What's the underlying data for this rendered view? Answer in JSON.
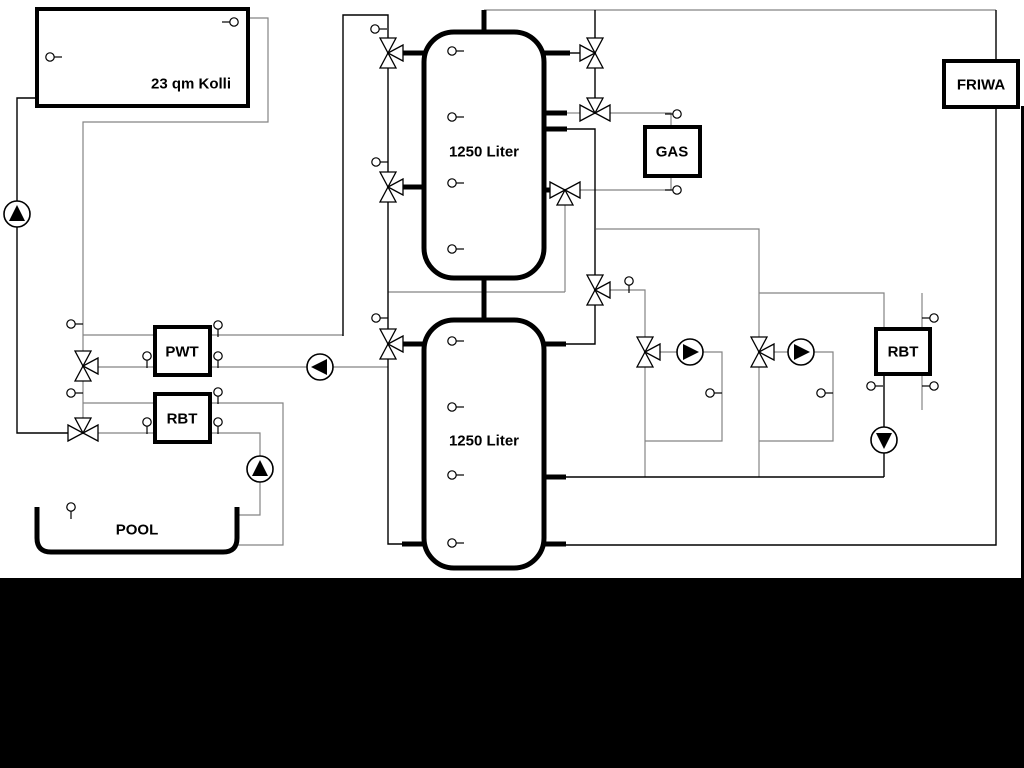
{
  "title": "Hydraulic heating schematic",
  "colors": {
    "line_black": "#000000",
    "line_gray": "#848484",
    "background": "#ffffff",
    "letterbox": "#000000"
  },
  "boxes": [
    {
      "name": "solar-collector",
      "label": "23 qm Kolli",
      "x": 37,
      "y": 9,
      "w": 211,
      "h": 97,
      "lx": 191,
      "ly": 84
    },
    {
      "name": "gas-boiler",
      "label": "GAS",
      "x": 645,
      "y": 127,
      "w": 55,
      "h": 49,
      "lx": 672,
      "ly": 152
    },
    {
      "name": "friwa-station",
      "label": "FRIWA",
      "x": 944,
      "y": 61,
      "w": 74,
      "h": 46,
      "lx": 981,
      "ly": 85
    },
    {
      "name": "pwt-heat-exchanger",
      "label": "PWT",
      "x": 155,
      "y": 327,
      "w": 55,
      "h": 48,
      "lx": 182,
      "ly": 352
    },
    {
      "name": "rbt-left",
      "label": "RBT",
      "x": 155,
      "y": 394,
      "w": 55,
      "h": 48,
      "lx": 182,
      "ly": 419
    },
    {
      "name": "rbt-right",
      "label": "RBT",
      "x": 876,
      "y": 329,
      "w": 54,
      "h": 45,
      "lx": 903,
      "ly": 352
    }
  ],
  "tanks": [
    {
      "name": "buffer-tank-1",
      "label": "1250 Liter",
      "x": 424,
      "y": 32,
      "w": 120,
      "h": 246,
      "lx": 484,
      "ly": 152
    },
    {
      "name": "buffer-tank-2",
      "label": "1250 Liter",
      "x": 424,
      "y": 320,
      "w": 120,
      "h": 248,
      "lx": 484,
      "ly": 441
    }
  ],
  "pool": {
    "name": "pool",
    "label": "POOL",
    "x1": 37,
    "x2": 237,
    "ytop": 507,
    "ybot": 552,
    "r": 14,
    "lx": 137,
    "ly": 530
  },
  "valves": [
    {
      "x": 388,
      "y": 53,
      "o": "v",
      "t": "right"
    },
    {
      "x": 388,
      "y": 187,
      "o": "v",
      "t": "right"
    },
    {
      "x": 388,
      "y": 344,
      "o": "v",
      "t": "right"
    },
    {
      "x": 595,
      "y": 53,
      "o": "v",
      "t": "left"
    },
    {
      "x": 595,
      "y": 113,
      "o": "h",
      "t": "top"
    },
    {
      "x": 565,
      "y": 190,
      "o": "h",
      "t": "bottom"
    },
    {
      "x": 595,
      "y": 290,
      "o": "v",
      "t": "right"
    },
    {
      "x": 645,
      "y": 352,
      "o": "v",
      "t": "right"
    },
    {
      "x": 759,
      "y": 352,
      "o": "v",
      "t": "right"
    },
    {
      "x": 83,
      "y": 366,
      "o": "v",
      "t": "right"
    },
    {
      "x": 83,
      "y": 433,
      "o": "h",
      "t": "top"
    }
  ],
  "pumps": [
    {
      "x": 17,
      "y": 214,
      "d": "up"
    },
    {
      "x": 320,
      "y": 367,
      "d": "left"
    },
    {
      "x": 260,
      "y": 469,
      "d": "up"
    },
    {
      "x": 690,
      "y": 352,
      "d": "right"
    },
    {
      "x": 801,
      "y": 352,
      "d": "right"
    },
    {
      "x": 884,
      "y": 440,
      "d": "down"
    }
  ],
  "sensors": [
    {
      "x": 50,
      "y": 57,
      "s": "r"
    },
    {
      "x": 234,
      "y": 22,
      "s": "l"
    },
    {
      "x": 452,
      "y": 51,
      "s": "r"
    },
    {
      "x": 452,
      "y": 117,
      "s": "r"
    },
    {
      "x": 452,
      "y": 183,
      "s": "r"
    },
    {
      "x": 452,
      "y": 249,
      "s": "r"
    },
    {
      "x": 452,
      "y": 341,
      "s": "r"
    },
    {
      "x": 452,
      "y": 407,
      "s": "r"
    },
    {
      "x": 452,
      "y": 475,
      "s": "r"
    },
    {
      "x": 452,
      "y": 543,
      "s": "r"
    },
    {
      "x": 375,
      "y": 29,
      "s": "r"
    },
    {
      "x": 376,
      "y": 162,
      "s": "r"
    },
    {
      "x": 376,
      "y": 318,
      "s": "r"
    },
    {
      "x": 71,
      "y": 324,
      "s": "r"
    },
    {
      "x": 71,
      "y": 393,
      "s": "r"
    },
    {
      "x": 218,
      "y": 325,
      "s": "d"
    },
    {
      "x": 147,
      "y": 356,
      "s": "d"
    },
    {
      "x": 218,
      "y": 356,
      "s": "d"
    },
    {
      "x": 218,
      "y": 392,
      "s": "d"
    },
    {
      "x": 147,
      "y": 422,
      "s": "d"
    },
    {
      "x": 218,
      "y": 422,
      "s": "d"
    },
    {
      "x": 71,
      "y": 507,
      "s": "d"
    },
    {
      "x": 677,
      "y": 114,
      "s": "l"
    },
    {
      "x": 677,
      "y": 190,
      "s": "l"
    },
    {
      "x": 629,
      "y": 281,
      "s": "d"
    },
    {
      "x": 710,
      "y": 393,
      "s": "r"
    },
    {
      "x": 821,
      "y": 393,
      "s": "r"
    },
    {
      "x": 871,
      "y": 386,
      "s": "r"
    },
    {
      "x": 934,
      "y": 318,
      "s": "l"
    },
    {
      "x": 934,
      "y": 386,
      "s": "l"
    }
  ],
  "lines_black": [
    [
      [
        37,
        98
      ],
      [
        17,
        98
      ],
      [
        17,
        433
      ],
      [
        68,
        433
      ]
    ],
    [
      [
        343,
        336
      ],
      [
        343,
        15
      ],
      [
        388,
        15
      ],
      [
        388,
        38
      ]
    ],
    [
      [
        388,
        68
      ],
      [
        388,
        172
      ]
    ],
    [
      [
        388,
        202
      ],
      [
        388,
        329
      ]
    ],
    [
      [
        388,
        359
      ],
      [
        388,
        544
      ],
      [
        402,
        544
      ]
    ],
    [
      [
        595,
        10
      ],
      [
        595,
        38
      ]
    ],
    [
      [
        595,
        68
      ],
      [
        595,
        98
      ]
    ],
    [
      [
        567,
        129
      ],
      [
        595,
        129
      ],
      [
        595,
        275
      ]
    ],
    [
      [
        595,
        305
      ],
      [
        595,
        344
      ],
      [
        566,
        344
      ]
    ],
    [
      [
        884,
        374
      ],
      [
        884,
        477
      ]
    ],
    [
      [
        565,
        477
      ],
      [
        884,
        477
      ]
    ],
    [
      [
        996,
        10
      ],
      [
        996,
        61
      ]
    ],
    [
      [
        996,
        107
      ],
      [
        996,
        545
      ],
      [
        565,
        545
      ]
    ],
    [
      [
        570,
        53
      ],
      [
        580,
        53
      ]
    ]
  ],
  "lines_gray": [
    [
      [
        248,
        18
      ],
      [
        268,
        18
      ],
      [
        268,
        122
      ],
      [
        83,
        122
      ],
      [
        83,
        351
      ]
    ],
    [
      [
        83,
        335
      ],
      [
        155,
        335
      ]
    ],
    [
      [
        210,
        335
      ],
      [
        343,
        335
      ]
    ],
    [
      [
        98,
        367
      ],
      [
        155,
        367
      ]
    ],
    [
      [
        210,
        367
      ],
      [
        388,
        367
      ]
    ],
    [
      [
        388,
        292
      ],
      [
        565,
        292
      ]
    ],
    [
      [
        565,
        292
      ],
      [
        565,
        205
      ]
    ],
    [
      [
        484,
        10
      ],
      [
        996,
        10
      ]
    ],
    [
      [
        610,
        290
      ],
      [
        645,
        290
      ],
      [
        645,
        337
      ]
    ],
    [
      [
        660,
        352
      ],
      [
        678,
        352
      ]
    ],
    [
      [
        702,
        352
      ],
      [
        722,
        352
      ],
      [
        722,
        441
      ],
      [
        645,
        441
      ]
    ],
    [
      [
        645,
        367
      ],
      [
        645,
        477
      ]
    ],
    [
      [
        596,
        229
      ],
      [
        759,
        229
      ],
      [
        759,
        337
      ]
    ],
    [
      [
        759,
        293
      ],
      [
        884,
        293
      ],
      [
        884,
        329
      ]
    ],
    [
      [
        774,
        352
      ],
      [
        789,
        352
      ]
    ],
    [
      [
        813,
        352
      ],
      [
        833,
        352
      ],
      [
        833,
        441
      ],
      [
        759,
        441
      ]
    ],
    [
      [
        759,
        367
      ],
      [
        759,
        477
      ]
    ],
    [
      [
        922,
        293
      ],
      [
        922,
        410
      ]
    ],
    [
      [
        610,
        113
      ],
      [
        671,
        113
      ],
      [
        671,
        127
      ]
    ],
    [
      [
        580,
        190
      ],
      [
        671,
        190
      ],
      [
        671,
        176
      ]
    ],
    [
      [
        83,
        381
      ],
      [
        83,
        418
      ]
    ],
    [
      [
        83,
        403
      ],
      [
        155,
        403
      ]
    ],
    [
      [
        210,
        403
      ],
      [
        283,
        403
      ],
      [
        283,
        545
      ],
      [
        237,
        545
      ]
    ],
    [
      [
        98,
        433
      ],
      [
        155,
        433
      ]
    ],
    [
      [
        210,
        433
      ],
      [
        260,
        433
      ],
      [
        260,
        456
      ]
    ],
    [
      [
        260,
        482
      ],
      [
        260,
        515
      ],
      [
        237,
        515
      ]
    ],
    [
      [
        567,
        113
      ],
      [
        580,
        113
      ]
    ]
  ],
  "pipes_thick": [
    [
      [
        402,
        53
      ],
      [
        424,
        53
      ]
    ],
    [
      [
        402,
        187
      ],
      [
        424,
        187
      ]
    ],
    [
      [
        402,
        344
      ],
      [
        424,
        344
      ]
    ],
    [
      [
        402,
        544
      ],
      [
        424,
        544
      ]
    ],
    [
      [
        544,
        53
      ],
      [
        570,
        53
      ]
    ],
    [
      [
        544,
        113
      ],
      [
        567,
        113
      ]
    ],
    [
      [
        544,
        129
      ],
      [
        567,
        129
      ]
    ],
    [
      [
        544,
        190
      ],
      [
        550,
        190
      ]
    ],
    [
      [
        544,
        344
      ],
      [
        566,
        344
      ]
    ],
    [
      [
        544,
        477
      ],
      [
        566,
        477
      ]
    ],
    [
      [
        544,
        544
      ],
      [
        566,
        544
      ]
    ],
    [
      [
        484,
        10
      ],
      [
        484,
        32
      ]
    ],
    [
      [
        484,
        278
      ],
      [
        484,
        320
      ]
    ]
  ],
  "letterbox": {
    "bottom": {
      "x": 0,
      "y": 578,
      "w": 1024,
      "h": 190
    },
    "right": {
      "x": 1021,
      "y": 106,
      "w": 3,
      "h": 472
    }
  }
}
